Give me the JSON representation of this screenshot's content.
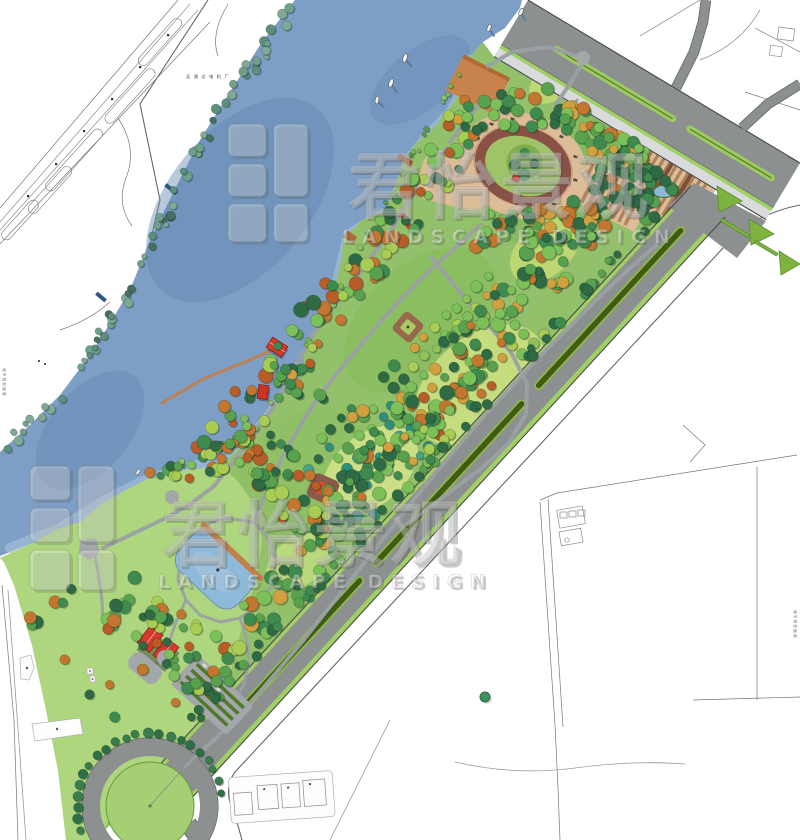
{
  "watermark": {
    "cn": "君怡景观",
    "en": "LANDSCAPE DESIGN"
  },
  "base_map": {
    "factory_label": "吴通达电机厂",
    "road_label_left": "城市规划道路",
    "road_label_right": "城市规划道路"
  },
  "palette": {
    "water": "#7d9ec5",
    "water_light": "#a9c4da",
    "water_dark": "#6488b2",
    "lawn": "#aed67f",
    "park_green": "#93c06a",
    "meadow": "#cfe183",
    "road_gray": "#8d9091",
    "road_edge": "#46494c",
    "sidewalk": "#d9dadb",
    "median_light": "#9ccb5f",
    "median_dark": "#3f5c15",
    "verge_green": "#a2cf63",
    "island_green": "#7fb33f",
    "plaza_tan": "#dcbd97",
    "stripe_brown": "#a0714c",
    "track_brown": "#8a5146",
    "mound_green": "#9fc468",
    "boardwalk": "#c0804e",
    "building_red": "#d5392b",
    "pond_blue": "#8fb9d9",
    "path_gray": "#9ba0a3",
    "cad_line": "#9a9a9a",
    "tree_greens": [
      "#2e6b45",
      "#3f8a4f",
      "#58a24f",
      "#7cc05a",
      "#a9cc55"
    ],
    "tree_teal": [
      "#2f8f7a",
      "#47a08a"
    ],
    "tree_warm": [
      "#c2762f",
      "#b85c28",
      "#d2a03f"
    ],
    "bank_veg": [
      "#5d8f7e",
      "#6fa08c",
      "#47705f",
      "#7fa895"
    ],
    "shrub": [
      "#7ab85a",
      "#8fc06a",
      "#569a46"
    ]
  }
}
